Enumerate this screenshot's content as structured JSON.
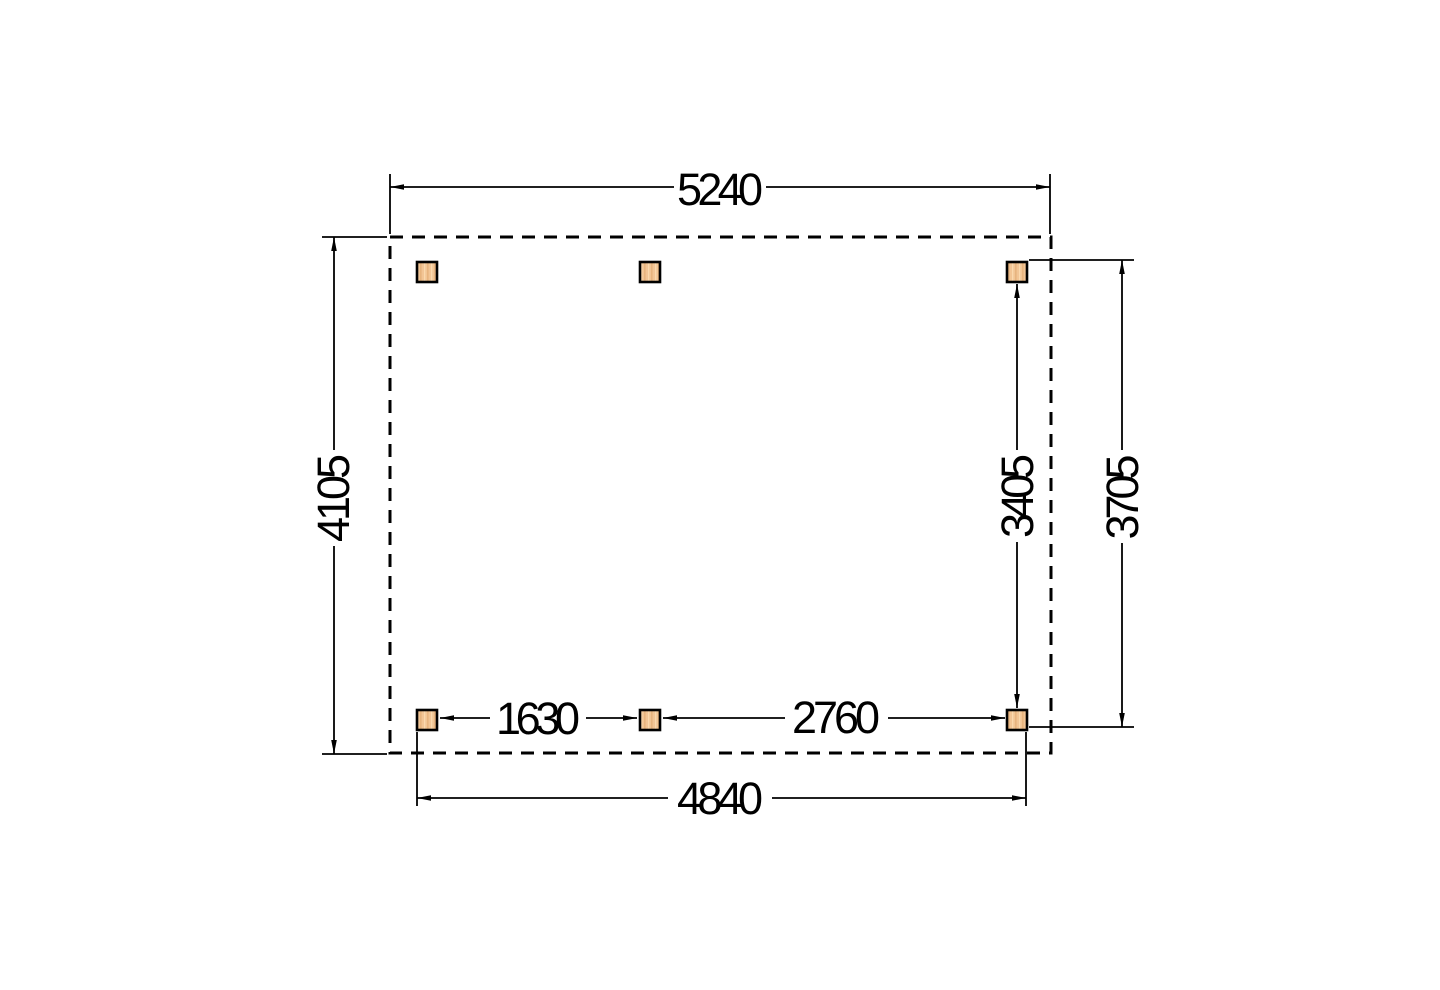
{
  "dimensions": {
    "top_width": "5240",
    "left_depth": "4105",
    "right_post_span": "3405",
    "right_overall": "3705",
    "bottom_span_left": "1630",
    "bottom_span_right": "2760",
    "bottom_width": "4840"
  },
  "colors": {
    "line": "#000000",
    "text": "#000000",
    "post_fill": "#f2c595",
    "post_grain_dark": "#e7b47e",
    "post_grain_light": "#fbd9ae",
    "post_border": "#000000",
    "background": "#ffffff"
  },
  "posts": {
    "count": "6"
  }
}
